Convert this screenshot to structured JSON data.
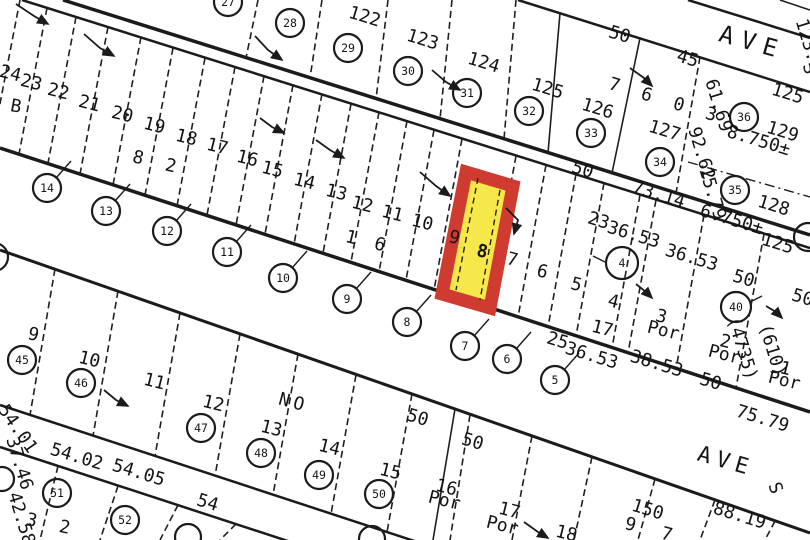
{
  "map": {
    "type": "assessor-plat-map",
    "colors": {
      "ink": "#1b1b1b",
      "paper": "#ffffff",
      "highlight_fill": "#f6e84b",
      "highlight_border": "#cf3a31"
    },
    "highlight": {
      "lot": "8",
      "fill": "#f6e84b",
      "border": "#cf3a31"
    },
    "streets": [
      {
        "label": "AVE"
      },
      {
        "label": "AVE"
      }
    ],
    "tract_numbers": [
      "7 6 0 3",
      "8 2",
      "1 6",
      "9 7",
      "3 2",
      "NO"
    ],
    "labels": [
      {
        "t": "24",
        "x": 9,
        "y": 79,
        "r": 14,
        "k": "lot"
      },
      {
        "t": "23",
        "x": 30,
        "y": 88,
        "r": 14,
        "k": "lot"
      },
      {
        "t": "22",
        "x": 57,
        "y": 97,
        "r": 14,
        "k": "lot"
      },
      {
        "t": "21",
        "x": 88,
        "y": 109,
        "r": 14,
        "k": "lot"
      },
      {
        "t": "20",
        "x": 121,
        "y": 120,
        "r": 14,
        "k": "lot"
      },
      {
        "t": "19",
        "x": 153,
        "y": 131,
        "r": 14,
        "k": "lot"
      },
      {
        "t": "18",
        "x": 185,
        "y": 143,
        "r": 14,
        "k": "lot"
      },
      {
        "t": "17",
        "x": 216,
        "y": 152,
        "r": 14,
        "k": "lot"
      },
      {
        "t": "16",
        "x": 246,
        "y": 164,
        "r": 14,
        "k": "lot"
      },
      {
        "t": "15",
        "x": 271,
        "y": 175,
        "r": 14,
        "k": "lot"
      },
      {
        "t": "14",
        "x": 303,
        "y": 187,
        "r": 14,
        "k": "lot"
      },
      {
        "t": "13",
        "x": 335,
        "y": 198,
        "r": 14,
        "k": "lot"
      },
      {
        "t": "12",
        "x": 361,
        "y": 210,
        "r": 14,
        "k": "lot"
      },
      {
        "t": "11",
        "x": 391,
        "y": 219,
        "r": 14,
        "k": "lot"
      },
      {
        "t": "10",
        "x": 421,
        "y": 228,
        "r": 14,
        "k": "lot"
      },
      {
        "t": "9",
        "x": 453,
        "y": 243,
        "r": 14,
        "k": "lot"
      },
      {
        "t": "8",
        "x": 481,
        "y": 257,
        "r": 12,
        "s": 28,
        "cls": "bold",
        "k": "lot"
      },
      {
        "t": "7",
        "x": 511,
        "y": 265,
        "r": 14,
        "k": "lot"
      },
      {
        "t": "6",
        "x": 541,
        "y": 277,
        "r": 14,
        "k": "lot"
      },
      {
        "t": "5",
        "x": 575,
        "y": 290,
        "r": 14,
        "k": "lot"
      },
      {
        "t": "4",
        "x": 612,
        "y": 307,
        "r": 14,
        "k": "lot"
      },
      {
        "t": "17",
        "x": 601,
        "y": 334,
        "r": 14,
        "s": 15,
        "k": "lot"
      },
      {
        "t": "3",
        "x": 660,
        "y": 322,
        "r": 14,
        "s": 16,
        "k": "lot"
      },
      {
        "t": "Por",
        "x": 662,
        "y": 336,
        "r": 14,
        "s": 9,
        "k": "lot"
      },
      {
        "t": "2",
        "x": 724,
        "y": 347,
        "r": 14,
        "s": 16,
        "k": "lot"
      },
      {
        "t": "Por",
        "x": 723,
        "y": 360,
        "r": 14,
        "s": 9,
        "k": "lot"
      },
      {
        "t": "1",
        "x": 784,
        "y": 374,
        "r": 14,
        "s": 16,
        "k": "lot"
      },
      {
        "t": "Por",
        "x": 783,
        "y": 386,
        "r": 14,
        "s": 9,
        "k": "lot"
      },
      {
        "t": "122",
        "x": 363,
        "y": 22,
        "r": 17,
        "s": 20,
        "k": "lot"
      },
      {
        "t": "123",
        "x": 421,
        "y": 45,
        "r": 17,
        "s": 20,
        "k": "lot"
      },
      {
        "t": "124",
        "x": 482,
        "y": 68,
        "r": 17,
        "s": 20,
        "k": "lot"
      },
      {
        "t": "125",
        "x": 546,
        "y": 94,
        "r": 17,
        "s": 20,
        "k": "lot"
      },
      {
        "t": "126",
        "x": 596,
        "y": 114,
        "r": 17,
        "s": 20,
        "k": "lot"
      },
      {
        "t": "127",
        "x": 663,
        "y": 136,
        "r": 17,
        "s": 20,
        "k": "lot"
      },
      {
        "t": "129",
        "x": 781,
        "y": 137,
        "r": 17,
        "s": 20,
        "k": "lot"
      },
      {
        "t": "128",
        "x": 772,
        "y": 211,
        "r": 17,
        "s": 20,
        "k": "lot"
      },
      {
        "t": "B",
        "x": 15,
        "y": 112,
        "r": 10,
        "s": 20,
        "k": "block"
      },
      {
        "t": "7 6 0 3",
        "x": 664,
        "y": 106,
        "r": 17,
        "s": 26,
        "ls": 6,
        "k": "tract"
      },
      {
        "t": "8 2",
        "x": 156,
        "y": 168,
        "r": 14,
        "s": 22,
        "ls": 6,
        "k": "tract"
      },
      {
        "t": "1 6",
        "x": 366,
        "y": 247,
        "r": 14,
        "s": 20,
        "ls": 4,
        "k": "tract"
      },
      {
        "t": "9 7",
        "x": 651,
        "y": 536,
        "r": 15,
        "s": 26,
        "ls": 8,
        "k": "tract"
      },
      {
        "t": "3 2",
        "x": 50,
        "y": 530,
        "r": 12,
        "s": 24,
        "ls": 6,
        "k": "tract"
      },
      {
        "t": "NO",
        "x": 292,
        "y": 408,
        "r": 15,
        "s": 22,
        "ls": 4,
        "k": "tract"
      },
      {
        "t": "9",
        "x": 32,
        "y": 340,
        "r": 14,
        "s": 18,
        "k": "lot"
      },
      {
        "t": "10",
        "x": 88,
        "y": 365,
        "r": 14,
        "s": 18,
        "k": "lot"
      },
      {
        "t": "11",
        "x": 153,
        "y": 387,
        "r": 14,
        "s": 18,
        "k": "lot"
      },
      {
        "t": "12",
        "x": 212,
        "y": 409,
        "r": 14,
        "s": 18,
        "k": "lot"
      },
      {
        "t": "13",
        "x": 270,
        "y": 434,
        "r": 14,
        "s": 18,
        "k": "lot"
      },
      {
        "t": "14",
        "x": 328,
        "y": 453,
        "r": 14,
        "s": 18,
        "k": "lot"
      },
      {
        "t": "15",
        "x": 389,
        "y": 477,
        "r": 14,
        "s": 18,
        "k": "lot"
      },
      {
        "t": "16",
        "x": 445,
        "y": 493,
        "r": 14,
        "s": 16,
        "k": "lot"
      },
      {
        "t": "Por",
        "x": 443,
        "y": 506,
        "r": 14,
        "s": 9,
        "k": "lot"
      },
      {
        "t": "17",
        "x": 508,
        "y": 516,
        "r": 14,
        "s": 16,
        "k": "lot"
      },
      {
        "t": "Por",
        "x": 501,
        "y": 531,
        "r": 14,
        "s": 9,
        "k": "lot"
      },
      {
        "t": "18",
        "x": 565,
        "y": 539,
        "r": 14,
        "s": 16,
        "k": "lot"
      },
      {
        "t": "S",
        "x": 804,
        "y": 70,
        "r": 75,
        "s": 11,
        "k": "street"
      },
      {
        "t": "S",
        "x": 770,
        "y": 490,
        "r": 70,
        "s": 10,
        "k": "street"
      },
      {
        "t": "50",
        "x": 618,
        "y": 40,
        "r": 17,
        "s": 10,
        "k": "dim"
      },
      {
        "t": "45",
        "x": 686,
        "y": 64,
        "r": 17,
        "s": 10,
        "k": "dim"
      },
      {
        "t": "125",
        "x": 786,
        "y": 99,
        "r": 17,
        "s": 10,
        "k": "dim"
      },
      {
        "t": "8.750±",
        "x": 757,
        "y": 146,
        "r": 17,
        "s": 10,
        "k": "dim"
      },
      {
        "t": "125",
        "x": 776,
        "y": 249,
        "r": 17,
        "s": 10,
        "k": "dim"
      },
      {
        "t": "6.750±",
        "x": 730,
        "y": 225,
        "r": 17,
        "s": 9,
        "k": "dim"
      },
      {
        "t": "73.14",
        "x": 657,
        "y": 200,
        "r": 17,
        "s": 10,
        "k": "dim"
      },
      {
        "t": "50",
        "x": 581,
        "y": 175,
        "r": 17,
        "s": 10,
        "k": "dim"
      },
      {
        "t": "23",
        "x": 597,
        "y": 226,
        "r": 17,
        "s": 10,
        "k": "dim"
      },
      {
        "t": "36.53",
        "x": 632,
        "y": 240,
        "r": 17,
        "s": 10,
        "k": "dim"
      },
      {
        "t": "36.53",
        "x": 690,
        "y": 263,
        "r": 17,
        "s": 10,
        "k": "dim"
      },
      {
        "t": "50",
        "x": 742,
        "y": 284,
        "r": 17,
        "s": 10,
        "k": "dim"
      },
      {
        "t": "50",
        "x": 709,
        "y": 387,
        "r": 17,
        "s": 10,
        "k": "dim"
      },
      {
        "t": "50",
        "x": 801,
        "y": 303,
        "r": 17,
        "s": 10,
        "k": "dim"
      },
      {
        "t": "25",
        "x": 556,
        "y": 346,
        "r": 17,
        "s": 10,
        "k": "dim"
      },
      {
        "t": "36.53",
        "x": 590,
        "y": 361,
        "r": 17,
        "s": 10,
        "k": "dim"
      },
      {
        "t": "38.53",
        "x": 655,
        "y": 369,
        "r": 17,
        "s": 10,
        "k": "dim"
      },
      {
        "t": "150",
        "x": 646,
        "y": 515,
        "r": 17,
        "s": 10,
        "k": "dim"
      },
      {
        "t": "88.19",
        "x": 738,
        "y": 521,
        "r": 17,
        "s": 10,
        "k": "dim"
      },
      {
        "t": "75.79",
        "x": 761,
        "y": 424,
        "r": 17,
        "s": 10,
        "k": "dim"
      },
      {
        "t": "54",
        "x": 206,
        "y": 508,
        "r": 17,
        "s": 10,
        "k": "dim"
      },
      {
        "t": "54.05",
        "x": 137,
        "y": 478,
        "r": 17,
        "s": 10,
        "k": "dim"
      },
      {
        "t": "54.02",
        "x": 75,
        "y": 462,
        "r": 17,
        "s": 10,
        "k": "dim"
      },
      {
        "t": "54.01",
        "x": 13,
        "y": 432,
        "r": 55,
        "s": 10,
        "k": "dim"
      },
      {
        "t": "50",
        "x": 416,
        "y": 423,
        "r": 17,
        "s": 10,
        "k": "dim"
      },
      {
        "t": "50",
        "x": 471,
        "y": 447,
        "r": 17,
        "s": 10,
        "k": "dim"
      },
      {
        "t": "61.69",
        "x": 713,
        "y": 107,
        "r": 73,
        "s": 10,
        "k": "dim"
      },
      {
        "t": "92.62",
        "x": 696,
        "y": 155,
        "r": 73,
        "s": 10,
        "k": "dim"
      },
      {
        "t": "15.79",
        "x": 707,
        "y": 195,
        "r": 73,
        "s": 10,
        "k": "dim"
      },
      {
        "t": "123.26",
        "x": 805,
        "y": 52,
        "r": 73,
        "s": 10,
        "k": "dim"
      },
      {
        "t": "37.46",
        "x": 14,
        "y": 465,
        "r": 73,
        "s": 10,
        "k": "dim"
      },
      {
        "t": "42.58",
        "x": 16,
        "y": 520,
        "r": 73,
        "s": 10,
        "k": "dim"
      },
      {
        "t": "(4735)",
        "x": 737,
        "y": 350,
        "r": 73,
        "s": 9,
        "k": "dim"
      },
      {
        "t": "(610)",
        "x": 767,
        "y": 352,
        "r": 73,
        "s": 9,
        "k": "dim"
      }
    ],
    "parcel_circles": [
      {
        "n": "27",
        "x": 228,
        "y": 2,
        "r": 14
      },
      {
        "n": "28",
        "x": 290,
        "y": 23,
        "r": 14
      },
      {
        "n": "29",
        "x": 348,
        "y": 48,
        "r": 14
      },
      {
        "n": "30",
        "x": 408,
        "y": 71,
        "r": 14
      },
      {
        "n": "31",
        "x": 467,
        "y": 93,
        "r": 14
      },
      {
        "n": "32",
        "x": 529,
        "y": 111,
        "r": 14
      },
      {
        "n": "33",
        "x": 591,
        "y": 133,
        "r": 14
      },
      {
        "n": "34",
        "x": 660,
        "y": 162,
        "r": 14
      },
      {
        "n": "36",
        "x": 744,
        "y": 117,
        "r": 14
      },
      {
        "n": "35",
        "x": 735,
        "y": 190,
        "r": 14
      },
      {
        "n": "14",
        "x": 47,
        "y": 188,
        "r": 14,
        "leader": true
      },
      {
        "n": "13",
        "x": 106,
        "y": 211,
        "r": 14,
        "leader": true
      },
      {
        "n": "12",
        "x": 167,
        "y": 231,
        "r": 14,
        "leader": true
      },
      {
        "n": "11",
        "x": 227,
        "y": 252,
        "r": 14,
        "leader": true
      },
      {
        "n": "10",
        "x": 283,
        "y": 278,
        "r": 14,
        "leader": true
      },
      {
        "n": "9",
        "x": 347,
        "y": 299,
        "r": 14,
        "leader": true
      },
      {
        "n": "8",
        "x": 407,
        "y": 322,
        "r": 14,
        "leader": true
      },
      {
        "n": "7",
        "x": 465,
        "y": 346,
        "r": 14,
        "leader": true
      },
      {
        "n": "6",
        "x": 507,
        "y": 359,
        "r": 14,
        "leader": true
      },
      {
        "n": "5",
        "x": 555,
        "y": 380,
        "r": 14,
        "leader": true
      },
      {
        "n": "4",
        "x": 622,
        "y": 263,
        "r": 16
      },
      {
        "n": "40",
        "x": 736,
        "y": 307,
        "r": 15
      },
      {
        "n": "45",
        "x": 22,
        "y": 360,
        "r": 14
      },
      {
        "n": "46",
        "x": 81,
        "y": 383,
        "r": 14
      },
      {
        "n": "47",
        "x": 201,
        "y": 428,
        "r": 14
      },
      {
        "n": "48",
        "x": 261,
        "y": 453,
        "r": 14
      },
      {
        "n": "49",
        "x": 319,
        "y": 475,
        "r": 14
      },
      {
        "n": "50",
        "x": 379,
        "y": 494,
        "r": 14
      },
      {
        "n": "51",
        "x": 57,
        "y": 493,
        "r": 14
      },
      {
        "n": "52",
        "x": 125,
        "y": 520,
        "r": 14
      },
      {
        "n": "",
        "x": -6,
        "y": 257,
        "r": 14
      },
      {
        "n": "",
        "x": 808,
        "y": 237,
        "r": 14
      },
      {
        "n": "",
        "x": 372,
        "y": 539,
        "r": 13
      },
      {
        "n": "",
        "x": 188,
        "y": 537,
        "r": 13
      },
      {
        "n": "",
        "x": 2,
        "y": 479,
        "r": 12
      }
    ]
  }
}
